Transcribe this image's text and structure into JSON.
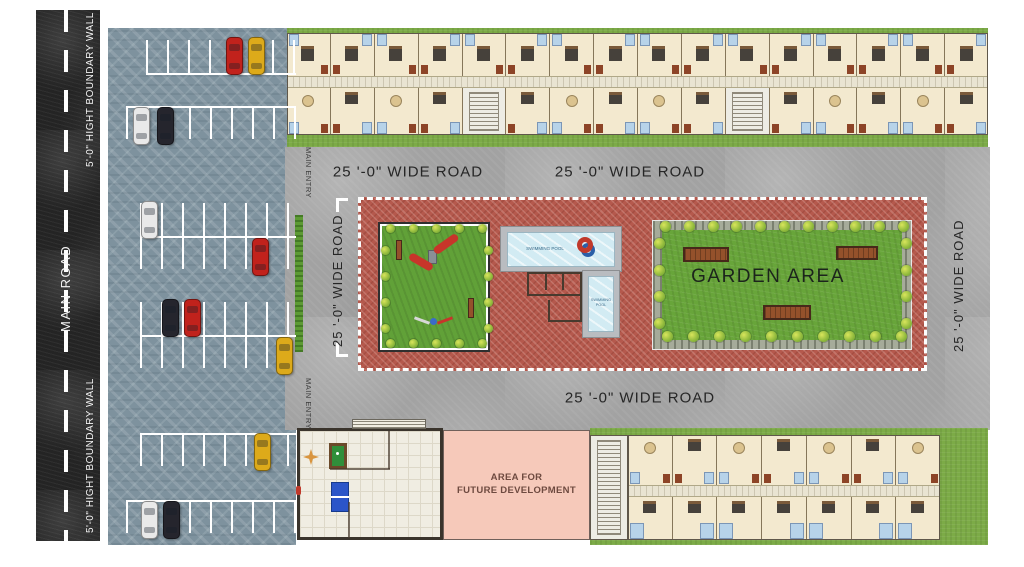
{
  "labels": {
    "main_road": "MAIN ROAD",
    "boundary_wall": "5'-0\" HIGHT BOUNDARY WALL",
    "wide_road": "25 '-0\" WIDE ROAD",
    "main_entry": "MAIN ENTRY",
    "garden_area": "GARDEN AREA",
    "future_development_line1": "AREA FOR",
    "future_development_line2": "FUTURE DEVELOPMENT",
    "swimming_pool": "SWIMMING POOL"
  },
  "colors": {
    "asphalt": "#242424",
    "paver_parking": "#7e929e",
    "concrete_road": "#a2a2a2",
    "brick_court": "#b5594d",
    "grass": "#7cab47",
    "lawn": "#68a53a",
    "unit_floor": "#f3e9cf",
    "corridor": "#e9e4d2",
    "pool_water": "#d2ebf3",
    "pool_deck": "#b9bcc0",
    "future_pink": "#f6c9ba",
    "bench_wood": "#94512b",
    "boundary_wall_line": "#ffffff",
    "stall_line": "#ffffff",
    "label_dark": "#262626"
  },
  "car_colors": {
    "red": "#c1221c",
    "yellow": "#ddaa1a",
    "white": "#e9e9e9",
    "black": "#25252d"
  },
  "parking": {
    "stall_groups": [
      {
        "y": 73,
        "x1": 146,
        "x2": 296,
        "dir": "up"
      },
      {
        "y": 106,
        "x1": 126,
        "x2": 296,
        "dir": "down"
      },
      {
        "y": 236,
        "x1": 140,
        "x2": 296,
        "dir": "both"
      },
      {
        "y": 335,
        "x1": 140,
        "x2": 296,
        "dir": "both"
      },
      {
        "y": 433,
        "x1": 140,
        "x2": 296,
        "dir": "down"
      },
      {
        "y": 500,
        "x1": 126,
        "x2": 296,
        "dir": "down"
      }
    ],
    "cars": [
      {
        "x": 226,
        "y": 37,
        "color": "red"
      },
      {
        "x": 248,
        "y": 37,
        "color": "yellow"
      },
      {
        "x": 133,
        "y": 107,
        "color": "white"
      },
      {
        "x": 157,
        "y": 107,
        "color": "black"
      },
      {
        "x": 141,
        "y": 201,
        "color": "white"
      },
      {
        "x": 252,
        "y": 238,
        "color": "red"
      },
      {
        "x": 162,
        "y": 299,
        "color": "black"
      },
      {
        "x": 184,
        "y": 299,
        "color": "red"
      },
      {
        "x": 276,
        "y": 337,
        "color": "yellow"
      },
      {
        "x": 254,
        "y": 433,
        "color": "yellow"
      },
      {
        "x": 141,
        "y": 501,
        "color": "white"
      },
      {
        "x": 163,
        "y": 501,
        "color": "black"
      }
    ]
  },
  "buildings": {
    "top": {
      "units_per_row": 16,
      "lobby_cells_bottom": [
        4,
        10
      ]
    },
    "bottom": {
      "units_per_row": 7
    }
  },
  "amenity": {
    "garden_benches": [
      {
        "x": 683,
        "y": 247,
        "w": 46,
        "h": 15
      },
      {
        "x": 836,
        "y": 246,
        "w": 42,
        "h": 14
      },
      {
        "x": 763,
        "y": 305,
        "w": 48,
        "h": 15
      }
    ],
    "tree_rows": [
      {
        "x1": 660,
        "x2": 898,
        "y": 221,
        "count": 11
      },
      {
        "x1": 662,
        "x2": 896,
        "y": 331,
        "count": 10
      },
      {
        "vert": true,
        "x": 654,
        "y1": 238,
        "y2": 318,
        "count": 4
      },
      {
        "vert": true,
        "x": 901,
        "y1": 238,
        "y2": 318,
        "count": 4
      },
      {
        "small": true,
        "x1": 386,
        "x2": 478,
        "y": 224,
        "count": 5
      },
      {
        "small": true,
        "x1": 386,
        "x2": 478,
        "y": 339,
        "count": 5
      },
      {
        "small": true,
        "vert": true,
        "x": 381,
        "y1": 246,
        "y2": 324,
        "count": 4
      },
      {
        "small": true,
        "vert": true,
        "x": 484,
        "y1": 246,
        "y2": 324,
        "count": 4
      }
    ]
  }
}
